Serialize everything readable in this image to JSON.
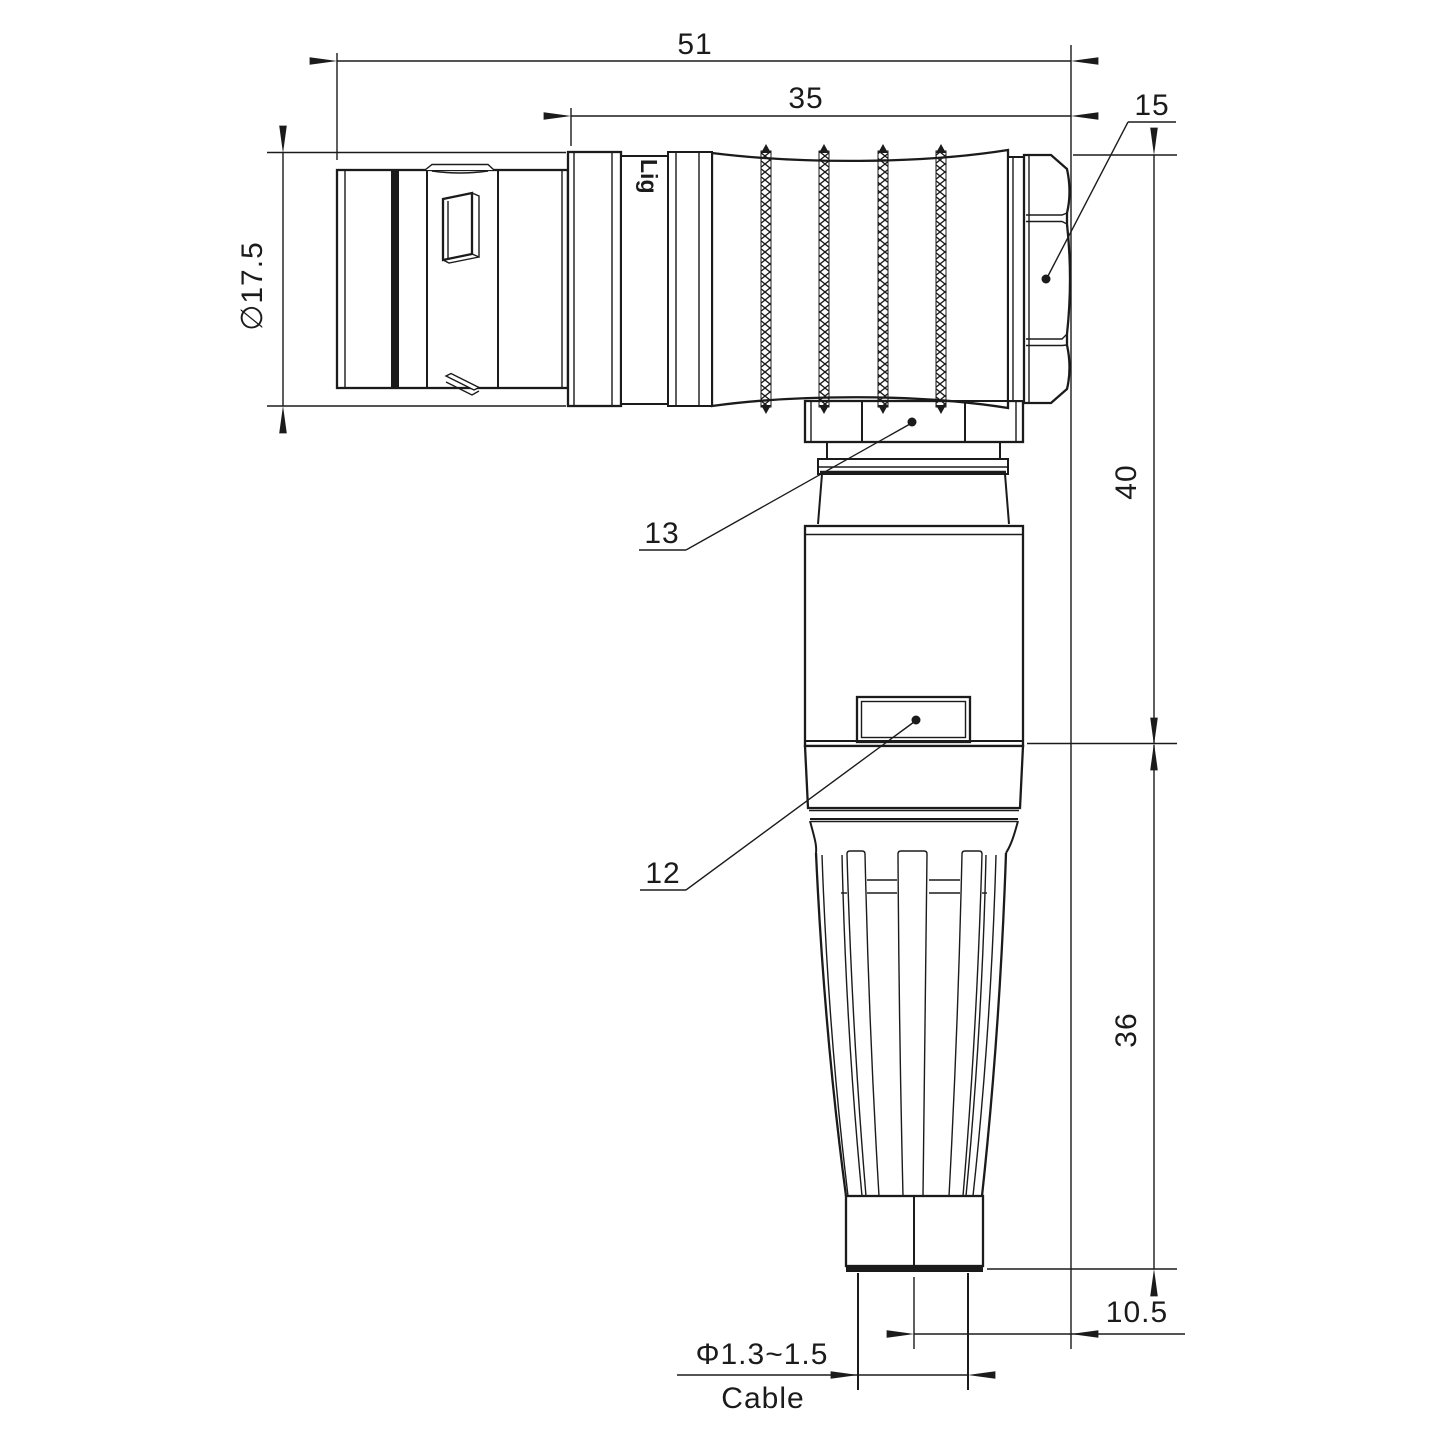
{
  "drawing_type": "connector right-angle plug technical drawing",
  "watermark": "Lightang",
  "part_marking": "Lig",
  "dims": {
    "overall_length": "51",
    "grip_length": "35",
    "front_diameter": "∅17.5",
    "upper_height": "40",
    "lower_height": "36",
    "side_offset": "10.5",
    "cable_diameter": "Φ1.3~1.5",
    "cable_label": "Cable"
  },
  "callouts": {
    "back_nut": "15",
    "coupling_nut": "13",
    "housing": "12"
  },
  "colors": {
    "line": "#1b1b1b",
    "background": "#ffffff",
    "watermark": "#f8d3d3"
  }
}
